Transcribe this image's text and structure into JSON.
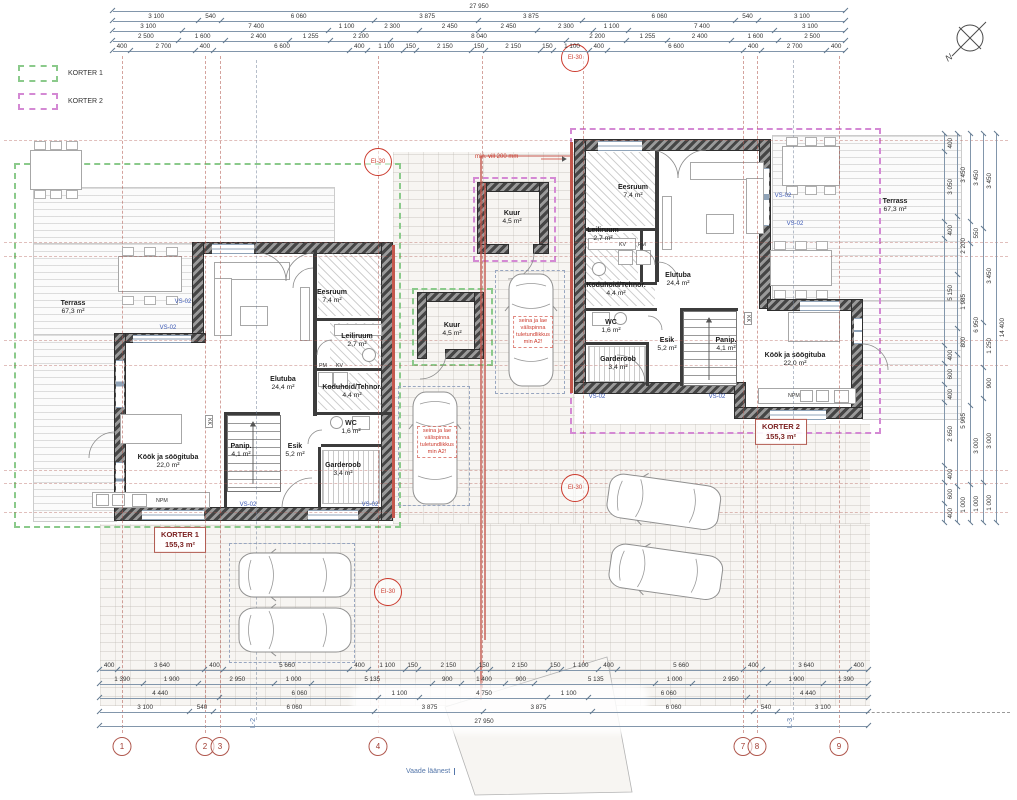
{
  "legend": {
    "items": [
      {
        "label": "KORTER 1",
        "color": "#8bca8b"
      },
      {
        "label": "KORTER 2",
        "color": "#d489d4"
      }
    ]
  },
  "compass": {
    "label": "N"
  },
  "dimensions": {
    "top_rows": [
      [
        "27 950"
      ],
      [
        "3 100",
        "540",
        "6 060",
        "3 875",
        "3 875",
        "6 060",
        "540",
        "3 100"
      ],
      [
        "3 100",
        "7 400",
        "1 100",
        "2 300",
        "2 450",
        "2 450",
        "2 300",
        "1 100",
        "7 400",
        "3 100"
      ],
      [
        "2 500",
        "1 600",
        "2 400",
        "1 255",
        "2 200",
        "8 040",
        "2 200",
        "1 255",
        "2 400",
        "1 600",
        "2 500"
      ],
      [
        "400",
        "2 700",
        "400",
        "6 600",
        "400",
        "1 100",
        "150",
        "2 150",
        "150",
        "2 150",
        "150",
        "1 100",
        "400",
        "6 600",
        "400",
        "2 700",
        "400"
      ]
    ],
    "bottom_rows": [
      [
        "400",
        "3 640",
        "400",
        "5 660",
        "400",
        "1 100",
        "150",
        "2 150",
        "150",
        "2 150",
        "150",
        "1 100",
        "400",
        "5 660",
        "400",
        "3 640",
        "400"
      ],
      [
        "1 390",
        "1 900",
        "2 950",
        "1 000",
        "5 135",
        "900",
        "1 400",
        "900",
        "5 135",
        "1 000",
        "2 950",
        "1 900",
        "1 390"
      ],
      [
        "4 440",
        "6 060",
        "1 100",
        "4 750",
        "1 100",
        "6 060",
        "4 440"
      ],
      [
        "3 100",
        "540",
        "6 060",
        "3 875",
        "3 875",
        "6 060",
        "540",
        "3 100"
      ],
      [
        "27 950"
      ]
    ],
    "right_rows": [
      [
        "400",
        "3 050",
        "400",
        "5 150",
        "400",
        "600",
        "400",
        "2 650",
        "400",
        "600",
        "400"
      ],
      [
        "3 450",
        "2 200",
        "1 985",
        "800",
        "5 965",
        "1 000"
      ],
      [
        "3 450",
        "550",
        "6 950",
        "3 000",
        "1 000"
      ],
      [
        "3 450",
        "3 450",
        "1 250",
        "900",
        "3 000",
        "1 000"
      ],
      [
        "14 400"
      ]
    ]
  },
  "grid_bubbles": [
    "1",
    "2",
    "3",
    "4",
    "5",
    "6",
    "7",
    "8",
    "9"
  ],
  "section_labels": {
    "l2": "L-2",
    "l3": "L-3",
    "view": "Vaade läänest"
  },
  "apartments": {
    "korter1": {
      "name": "KORTER 1",
      "area": "155,3 m²",
      "rooms": [
        {
          "name": "Terrass",
          "area": "67,3 m²"
        },
        {
          "name": "Eesruum",
          "area": "7,4 m²"
        },
        {
          "name": "Leiliruum",
          "area": "2,7 m²"
        },
        {
          "name": "Elutuba",
          "area": "24,4 m²"
        },
        {
          "name": "Koduhoid/Tehnor.",
          "area": "4,4 m²"
        },
        {
          "name": "WC",
          "area": "1,6 m²"
        },
        {
          "name": "Panip.",
          "area": "4,1 m²"
        },
        {
          "name": "Esik",
          "area": "5,2 m²"
        },
        {
          "name": "Garderoob",
          "area": "3,4 m²"
        },
        {
          "name": "Köök ja söögituba",
          "area": "22,0 m²"
        }
      ]
    },
    "korter2": {
      "name": "KORTER 2",
      "area": "155,3 m²",
      "rooms": [
        {
          "name": "Terrass",
          "area": "67,3 m²"
        },
        {
          "name": "Eesruum",
          "area": "7,4 m²"
        },
        {
          "name": "Leiliruum",
          "area": "2,7 m²"
        },
        {
          "name": "Elutuba",
          "area": "24,4 m²"
        },
        {
          "name": "Koduhoid/Tehnor.",
          "area": "4,4 m²"
        },
        {
          "name": "WC",
          "area": "1,6 m²"
        },
        {
          "name": "Panip.",
          "area": "4,1 m²"
        },
        {
          "name": "Esik",
          "area": "5,2 m²"
        },
        {
          "name": "Garderoob",
          "area": "3,4 m²"
        },
        {
          "name": "Köök ja söögituba",
          "area": "22,0 m²"
        }
      ]
    }
  },
  "sheds": [
    {
      "name": "Kuur",
      "area": "4,5 m²"
    },
    {
      "name": "Kuur",
      "area": "4,5 m²"
    }
  ],
  "annotations": {
    "fire_rating": "EI-30",
    "min_vill": "min. vill 200 mm",
    "fire_note_lines": [
      "seina ja lae",
      "välispinna",
      "tuletundlikkus",
      "min A2!"
    ],
    "vs02": "VS-02",
    "npm": "NPM",
    "kk": "KK",
    "kv": "KV",
    "pm": "PM"
  },
  "colors": {
    "fire_wall": "#c4574d",
    "grid_red": "#b0584e",
    "annotation_red": "#cc3b2e",
    "dim_line": "#8296ab",
    "vs_blue": "#3a57b5",
    "section_blue": "#5577aa",
    "korter1_dash": "#8bca8b",
    "korter2_dash": "#d489d4"
  }
}
